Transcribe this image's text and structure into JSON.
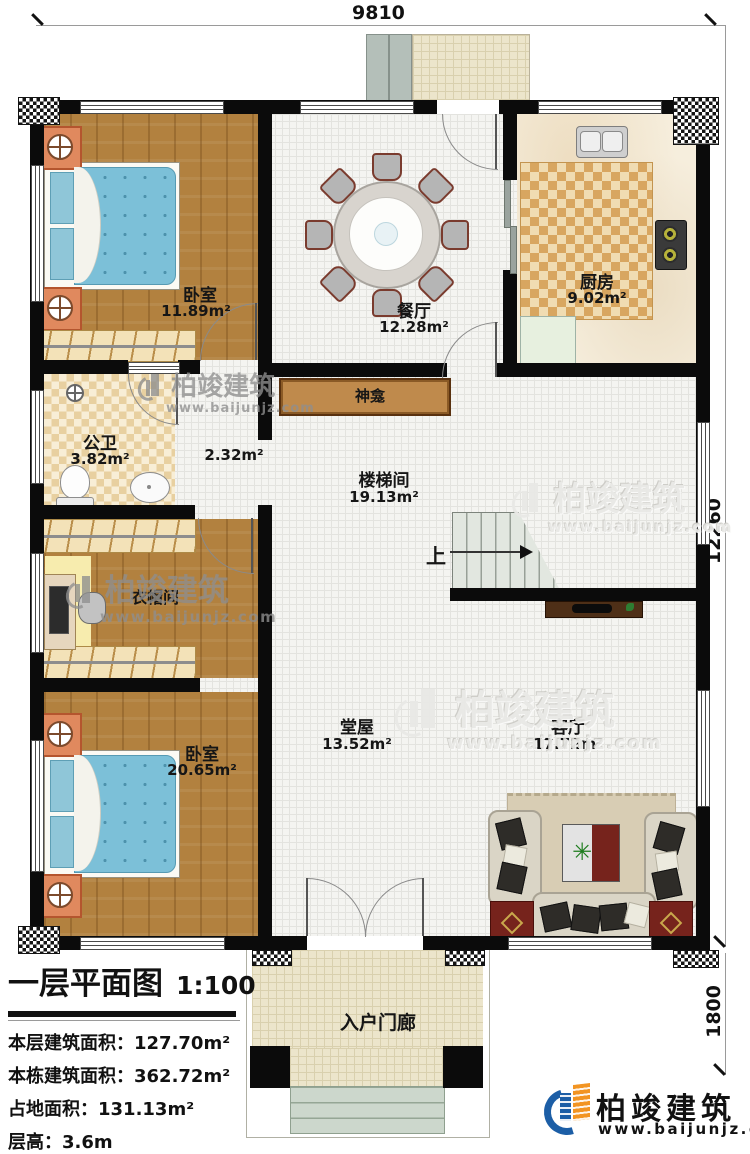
{
  "meta": {
    "drawing_type": "floor-plan"
  },
  "dimensions": {
    "width_top": "9810",
    "height_right": "12260",
    "porch_depth": "1800"
  },
  "rooms": {
    "bedroom1": {
      "name": "卧室",
      "area": "11.89m²"
    },
    "dining": {
      "name": "餐厅",
      "area": "12.28m²"
    },
    "kitchen": {
      "name": "厨房",
      "area": "9.02m²"
    },
    "bathroom": {
      "name": "公卫",
      "area": "3.82m²"
    },
    "hallway": {
      "area": "2.32m²"
    },
    "stairhall": {
      "name": "楼梯间",
      "area": "19.13m²"
    },
    "shrine": {
      "name": "神龛"
    },
    "cloakroom": {
      "name": "衣帽间"
    },
    "bedroom2": {
      "name": "卧室",
      "area": "20.65m²"
    },
    "mainhall": {
      "name": "堂屋",
      "area": "13.52m²"
    },
    "living": {
      "name": "客厅",
      "area": "17.72m²"
    },
    "porch": {
      "name": "入户门廊"
    }
  },
  "stairs": {
    "direction_label": "上"
  },
  "title_block": {
    "drawing_title": "一层平面图",
    "scale": "1:100",
    "rows": [
      {
        "label": "本层建筑面积：",
        "value": "127.70m²"
      },
      {
        "label": "本栋建筑面积：",
        "value": "362.72m²"
      },
      {
        "label": "占地面积：",
        "value": "131.13m²"
      },
      {
        "label": "层高：",
        "value": "3.6m"
      }
    ]
  },
  "brand": {
    "company": "柏竣建筑",
    "website": "www.baijunjz.com"
  },
  "colors": {
    "wall": "#0b0b0b",
    "wood_floor": "#b2813f",
    "bed_blue": "#7cc0d8",
    "checker_tan": "#d8a660",
    "logo_blue": "#1c5ea6",
    "logo_orange": "#f29422"
  }
}
